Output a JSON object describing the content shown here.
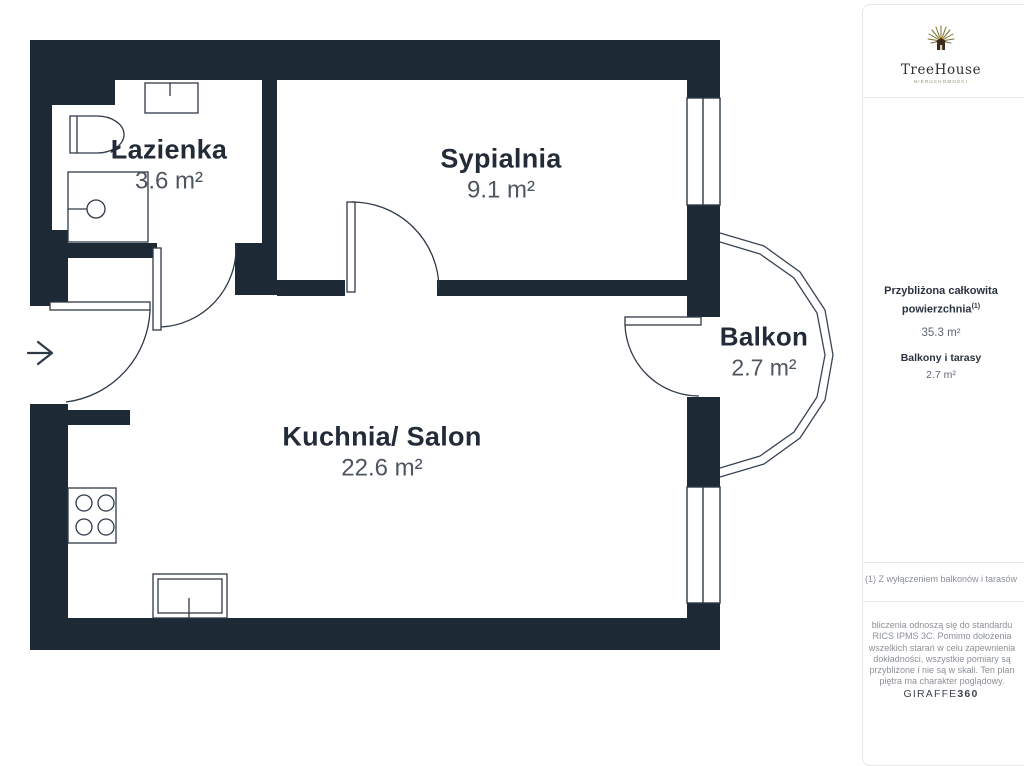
{
  "floorplan": {
    "wall_color": "#1e2936",
    "line_color": "#2e3947",
    "rooms": [
      {
        "id": "lazienka",
        "name": "Łazienka",
        "area": "3.6 m²"
      },
      {
        "id": "sypialnia",
        "name": "Sypialnia",
        "area": "9.1 m²"
      },
      {
        "id": "kuchnia-salon",
        "name": "Kuchnia/ Salon",
        "area": "22.6 m²"
      },
      {
        "id": "balkon",
        "name": "Balkon",
        "area": "2.7 m²"
      }
    ]
  },
  "sidebar": {
    "logo": {
      "brand": "TreeHouse",
      "tagline": "NIERUCHOMOŚCI"
    },
    "summary": {
      "total_label": "Przybliżona całkowita powierzchnia",
      "total_superscript": "(1)",
      "total_value": "35.3 m²",
      "balcony_label": "Balkony i tarasy",
      "balcony_value": "2.7 m²"
    },
    "footnote": "(1) Z wyłączeniem balkonów i tarasów",
    "disclaimer": "bliczenia odnoszą się do standardu RICS IPMS 3C. Pomimo dołożenia wszelkich starań w celu zapewnienia dokładności, wszystkie pomiary są przybliżone i nie są w skali. Ten plan piętra ma charakter poglądowy.",
    "brand_footer": {
      "name": "GIRAFFE",
      "suffix": "360"
    }
  }
}
